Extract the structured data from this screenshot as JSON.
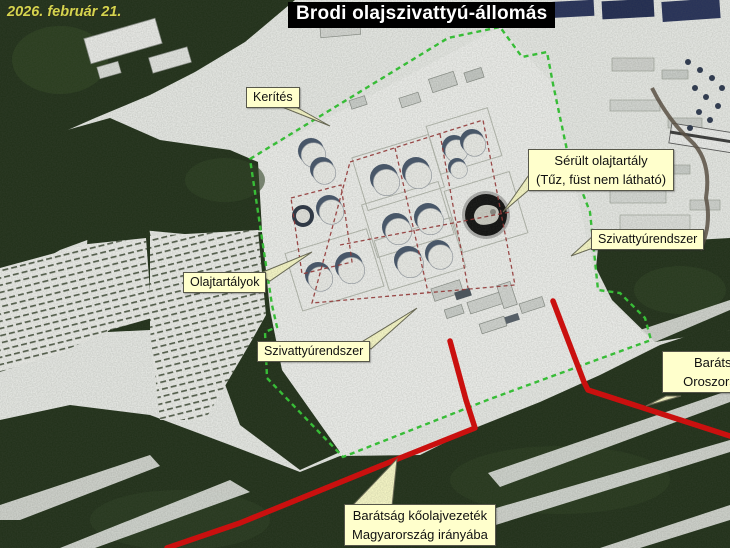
{
  "meta": {
    "date_label": "2026. február 21.",
    "title": "Brodi olajszivattyú-állomás"
  },
  "annotations": {
    "fence_label": "Kerítés",
    "damaged_tank": {
      "line1": "Sérült olajtartály",
      "line2": "(Tűz, füst nem látható)"
    },
    "pump_system_upper": "Szivattyúrendszer",
    "oil_tanks_label": "Olajtartályok",
    "pump_system_lower": "Szivattyúrendszer",
    "pipeline_russia": {
      "line1": "Barátság",
      "line2": "Oroszország"
    },
    "pipeline_hungary": {
      "line1": "Barátság kőolajvezeték",
      "line2": "Magyarország irányába"
    }
  },
  "legend_colors": {
    "fence_green": "#33cc33",
    "pipeline_red": "#dc0404",
    "tank_bund_red": "#9a3333",
    "label_background": "#ffffcc",
    "date_text_yellow": "#d4d44e",
    "title_background": "#000000",
    "title_text": "#ffffff"
  }
}
